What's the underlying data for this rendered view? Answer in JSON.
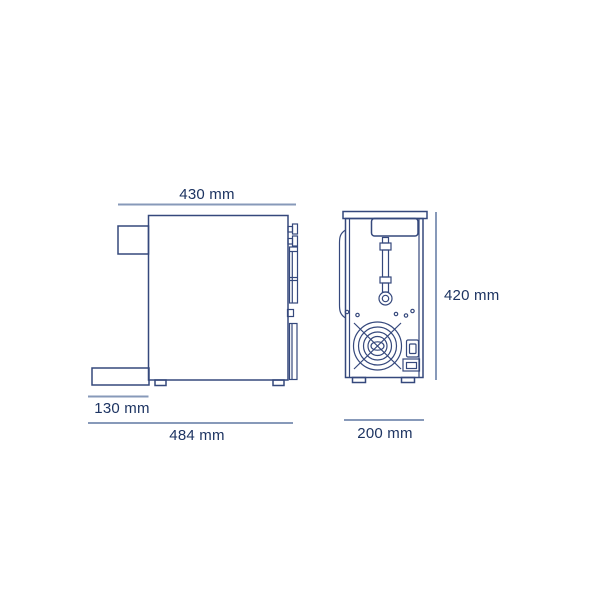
{
  "drawing": {
    "colors": {
      "background": "#ffffff",
      "outline": "#35487c",
      "dimline": "#8799b9",
      "label": "#1d3462"
    },
    "dimensions": {
      "top_width": "430 mm",
      "height": "420 mm",
      "tray_depth": "130 mm",
      "total_depth": "484 mm",
      "rear_width": "200 mm"
    }
  }
}
